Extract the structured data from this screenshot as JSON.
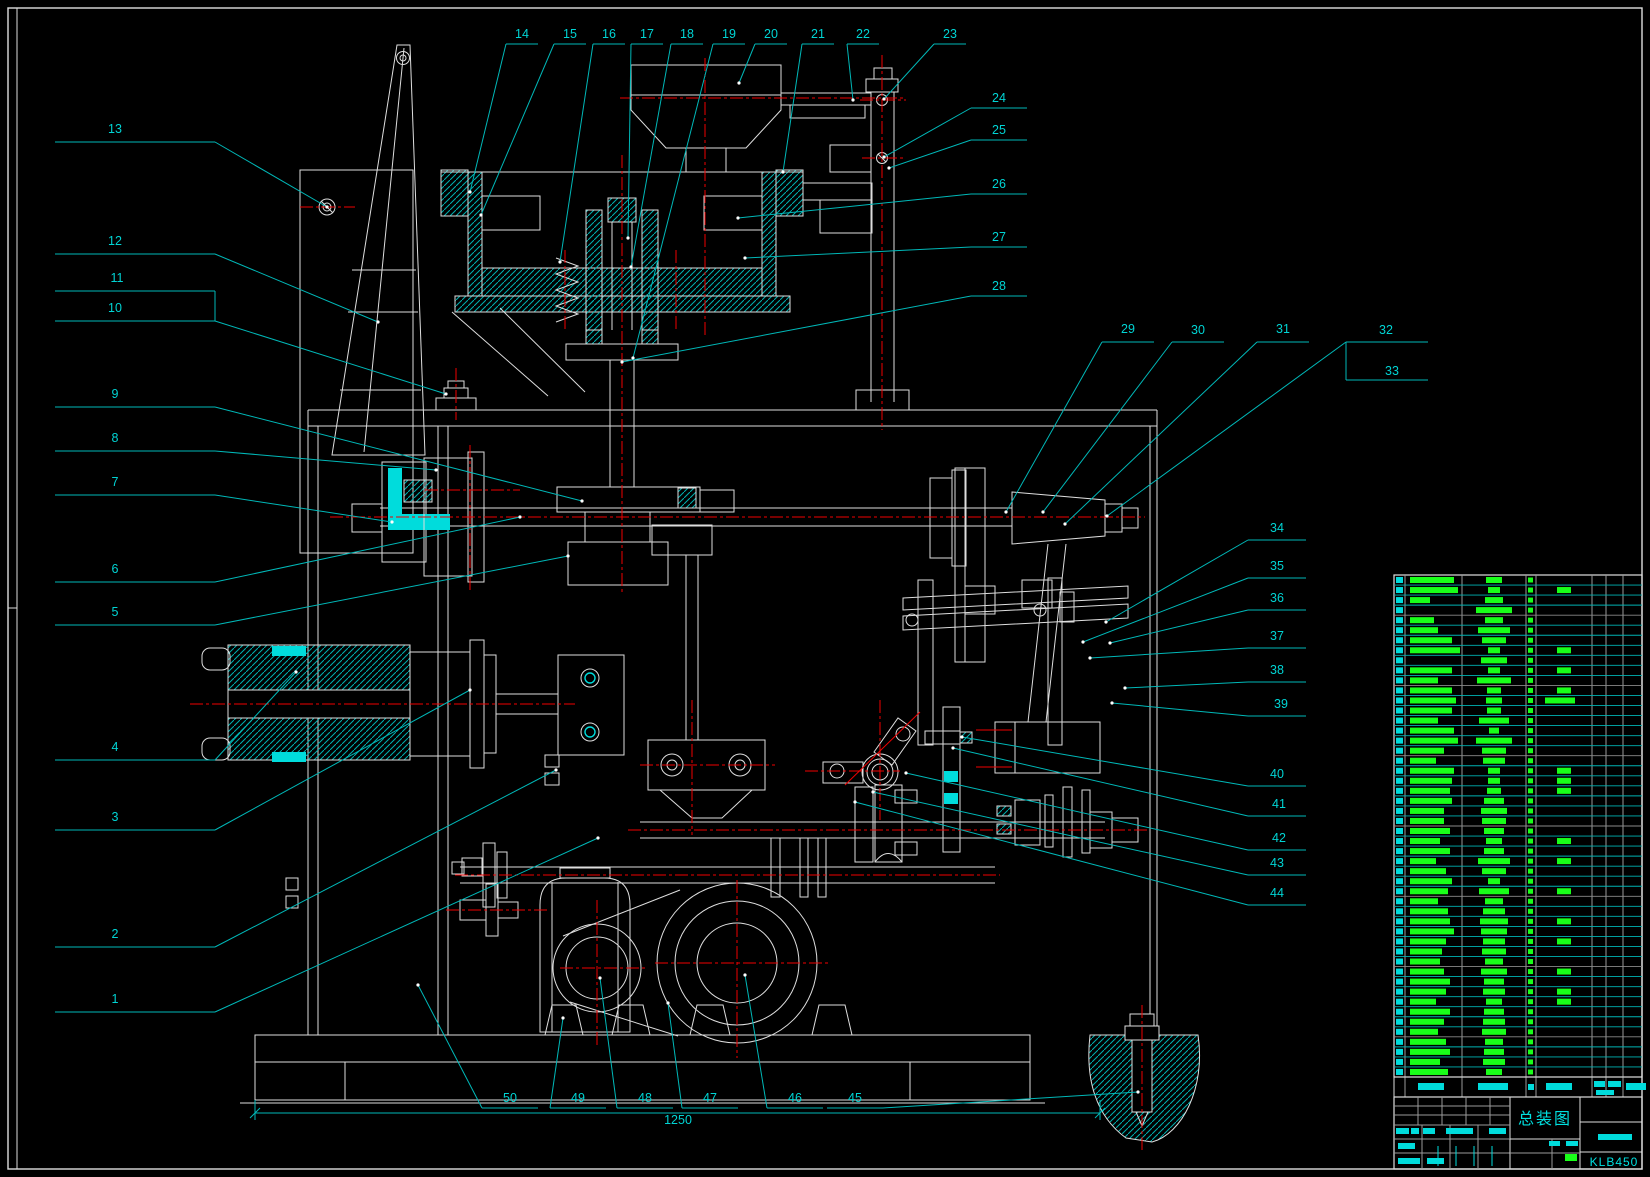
{
  "canvas": {
    "width": 1650,
    "height": 1177,
    "background": "#000000"
  },
  "colors": {
    "geometry_white": "#dedede",
    "leader_cyan": "#00b8b8",
    "text_cyan": "#00d4d4",
    "bright_cyan": "#00dcdc",
    "parts_green": "#19ff19",
    "centerline_red": "#f00000",
    "grid_gray": "#9a9a9a"
  },
  "title_block": {
    "title": "总装图",
    "drawing_number": "KLB450"
  },
  "dimension": {
    "value": "1250"
  },
  "callouts": [
    {
      "n": "1",
      "tx": 115,
      "ty": 1003,
      "line": [
        55,
        1012,
        215
      ],
      "leader": [
        [
          215,
          1012
        ],
        [
          598,
          838
        ]
      ]
    },
    {
      "n": "2",
      "tx": 115,
      "ty": 938,
      "line": [
        55,
        947,
        215
      ],
      "leader": [
        [
          215,
          947
        ],
        [
          556,
          770
        ]
      ]
    },
    {
      "n": "3",
      "tx": 115,
      "ty": 821,
      "line": [
        55,
        830,
        215
      ],
      "leader": [
        [
          215,
          830
        ],
        [
          470,
          690
        ]
      ]
    },
    {
      "n": "4",
      "tx": 115,
      "ty": 751,
      "line": [
        55,
        760,
        215
      ],
      "leader": [
        [
          215,
          760
        ],
        [
          296,
          672
        ]
      ]
    },
    {
      "n": "5",
      "tx": 115,
      "ty": 616,
      "line": [
        55,
        625,
        215
      ],
      "leader": [
        [
          215,
          625
        ],
        [
          568,
          556
        ]
      ]
    },
    {
      "n": "6",
      "tx": 115,
      "ty": 573,
      "line": [
        55,
        582,
        215
      ],
      "leader": [
        [
          215,
          582
        ],
        [
          520,
          517
        ]
      ]
    },
    {
      "n": "7",
      "tx": 115,
      "ty": 486,
      "line": [
        55,
        495,
        215
      ],
      "leader": [
        [
          215,
          495
        ],
        [
          392,
          522
        ]
      ]
    },
    {
      "n": "8",
      "tx": 115,
      "ty": 442,
      "line": [
        55,
        451,
        215
      ],
      "leader": [
        [
          215,
          451
        ],
        [
          436,
          470
        ]
      ]
    },
    {
      "n": "9",
      "tx": 115,
      "ty": 398,
      "line": [
        55,
        407,
        215
      ],
      "leader": [
        [
          215,
          407
        ],
        [
          582,
          501
        ]
      ]
    },
    {
      "n": "10",
      "tx": 115,
      "ty": 312,
      "line": [
        55,
        321,
        215
      ],
      "leader": [
        [
          215,
          321
        ],
        [
          446,
          394
        ]
      ]
    },
    {
      "n": "11",
      "tx": 117,
      "ty": 282,
      "line": [
        55,
        291,
        215
      ],
      "brv": [
        215,
        291,
        215,
        321
      ]
    },
    {
      "n": "12",
      "tx": 115,
      "ty": 245,
      "line": [
        55,
        254,
        215
      ],
      "leader": [
        [
          215,
          254
        ],
        [
          378,
          322
        ]
      ]
    },
    {
      "n": "13",
      "tx": 115,
      "ty": 133,
      "line": [
        55,
        142,
        215
      ],
      "leader": [
        [
          215,
          142
        ],
        [
          327,
          207
        ]
      ]
    },
    {
      "n": "14",
      "tx": 522,
      "ty": 38,
      "line": [
        506,
        44,
        538
      ],
      "leader": [
        [
          506,
          44
        ],
        [
          470,
          192
        ]
      ]
    },
    {
      "n": "15",
      "tx": 570,
      "ty": 38,
      "line": [
        554,
        44,
        586
      ],
      "leader": [
        [
          554,
          44
        ],
        [
          481,
          215
        ]
      ]
    },
    {
      "n": "16",
      "tx": 609,
      "ty": 38,
      "line": [
        593,
        44,
        625
      ],
      "leader": [
        [
          593,
          44
        ],
        [
          560,
          262
        ]
      ]
    },
    {
      "n": "17",
      "tx": 647,
      "ty": 38,
      "line": [
        631,
        44,
        663
      ],
      "leader": [
        [
          631,
          44
        ],
        [
          628,
          238
        ]
      ]
    },
    {
      "n": "18",
      "tx": 687,
      "ty": 38,
      "line": [
        671,
        44,
        703
      ],
      "leader": [
        [
          671,
          44
        ],
        [
          631,
          267
        ]
      ]
    },
    {
      "n": "19",
      "tx": 729,
      "ty": 38,
      "line": [
        713,
        44,
        745
      ],
      "leader": [
        [
          713,
          44
        ],
        [
          633,
          358
        ]
      ]
    },
    {
      "n": "20",
      "tx": 771,
      "ty": 38,
      "line": [
        755,
        44,
        787
      ],
      "leader": [
        [
          755,
          44
        ],
        [
          739,
          83
        ]
      ]
    },
    {
      "n": "21",
      "tx": 818,
      "ty": 38,
      "line": [
        802,
        44,
        834
      ],
      "leader": [
        [
          802,
          44
        ],
        [
          783,
          172
        ]
      ]
    },
    {
      "n": "22",
      "tx": 863,
      "ty": 38,
      "line": [
        847,
        44,
        879
      ],
      "leader": [
        [
          847,
          44
        ],
        [
          853,
          100
        ]
      ]
    },
    {
      "n": "23",
      "tx": 950,
      "ty": 38,
      "line": [
        934,
        44,
        966
      ],
      "leader": [
        [
          934,
          44
        ],
        [
          884,
          99
        ]
      ]
    },
    {
      "n": "24",
      "tx": 999,
      "ty": 102,
      "line": [
        971,
        108,
        1027
      ],
      "leader": [
        [
          971,
          108
        ],
        [
          884,
          157
        ]
      ]
    },
    {
      "n": "25",
      "tx": 999,
      "ty": 134,
      "line": [
        971,
        140,
        1027
      ],
      "leader": [
        [
          971,
          140
        ],
        [
          889,
          168
        ]
      ]
    },
    {
      "n": "26",
      "tx": 999,
      "ty": 188,
      "line": [
        971,
        194,
        1027
      ],
      "leader": [
        [
          971,
          194
        ],
        [
          738,
          218
        ]
      ]
    },
    {
      "n": "27",
      "tx": 999,
      "ty": 241,
      "line": [
        971,
        247,
        1027
      ],
      "leader": [
        [
          971,
          247
        ],
        [
          745,
          258
        ]
      ]
    },
    {
      "n": "28",
      "tx": 999,
      "ty": 290,
      "line": [
        971,
        296,
        1027
      ],
      "leader": [
        [
          971,
          296
        ],
        [
          622,
          362
        ]
      ]
    },
    {
      "n": "29",
      "tx": 1128,
      "ty": 333,
      "line": [
        1102,
        342,
        1154
      ],
      "leader": [
        [
          1102,
          342
        ],
        [
          1006,
          512
        ]
      ]
    },
    {
      "n": "30",
      "tx": 1198,
      "ty": 334,
      "line": [
        1172,
        342,
        1224
      ],
      "leader": [
        [
          1172,
          342
        ],
        [
          1043,
          512
        ]
      ]
    },
    {
      "n": "31",
      "tx": 1283,
      "ty": 333,
      "line": [
        1257,
        342,
        1309
      ],
      "leader": [
        [
          1257,
          342
        ],
        [
          1065,
          524
        ]
      ]
    },
    {
      "n": "32",
      "tx": 1386,
      "ty": 334,
      "line": [
        1346,
        342,
        1428
      ],
      "brv": [
        1346,
        342,
        1346,
        380
      ],
      "leader": [
        [
          1346,
          342
        ],
        [
          1107,
          516
        ]
      ]
    },
    {
      "n": "33",
      "tx": 1392,
      "ty": 375,
      "line": [
        1346,
        380,
        1428
      ]
    },
    {
      "n": "34",
      "tx": 1277,
      "ty": 532,
      "line": [
        1248,
        540,
        1306
      ],
      "leader": [
        [
          1248,
          540
        ],
        [
          1106,
          622
        ]
      ]
    },
    {
      "n": "35",
      "tx": 1277,
      "ty": 570,
      "line": [
        1248,
        578,
        1306
      ],
      "leader": [
        [
          1248,
          578
        ],
        [
          1083,
          642
        ]
      ]
    },
    {
      "n": "36",
      "tx": 1277,
      "ty": 602,
      "line": [
        1248,
        610,
        1306
      ],
      "leader": [
        [
          1248,
          610
        ],
        [
          1110,
          643
        ]
      ]
    },
    {
      "n": "37",
      "tx": 1277,
      "ty": 640,
      "line": [
        1248,
        648,
        1306
      ],
      "leader": [
        [
          1248,
          648
        ],
        [
          1090,
          658
        ]
      ]
    },
    {
      "n": "38",
      "tx": 1277,
      "ty": 674,
      "line": [
        1248,
        682,
        1306
      ],
      "leader": [
        [
          1248,
          682
        ],
        [
          1125,
          688
        ]
      ]
    },
    {
      "n": "39",
      "tx": 1281,
      "ty": 708,
      "line": [
        1248,
        716,
        1306
      ],
      "leader": [
        [
          1248,
          716
        ],
        [
          1112,
          703
        ]
      ]
    },
    {
      "n": "40",
      "tx": 1277,
      "ty": 778,
      "line": [
        1248,
        786,
        1306
      ],
      "leader": [
        [
          1248,
          786
        ],
        [
          962,
          737
        ]
      ]
    },
    {
      "n": "41",
      "tx": 1279,
      "ty": 808,
      "line": [
        1248,
        816,
        1306
      ],
      "leader": [
        [
          1248,
          816
        ],
        [
          953,
          748
        ]
      ]
    },
    {
      "n": "42",
      "tx": 1279,
      "ty": 842,
      "line": [
        1248,
        850,
        1306
      ],
      "leader": [
        [
          1248,
          850
        ],
        [
          906,
          773
        ]
      ]
    },
    {
      "n": "43",
      "tx": 1277,
      "ty": 867,
      "line": [
        1248,
        875,
        1306
      ],
      "leader": [
        [
          1248,
          875
        ],
        [
          873,
          792
        ]
      ]
    },
    {
      "n": "44",
      "tx": 1277,
      "ty": 897,
      "line": [
        1248,
        905,
        1306
      ],
      "leader": [
        [
          1248,
          905
        ],
        [
          855,
          802
        ]
      ]
    },
    {
      "n": "45",
      "tx": 855,
      "ty": 1102,
      "line": [
        827,
        1108,
        883
      ],
      "leader": [
        [
          883,
          1108
        ],
        [
          1138,
          1092
        ]
      ]
    },
    {
      "n": "46",
      "tx": 795,
      "ty": 1102,
      "line": [
        767,
        1108,
        823
      ],
      "leader": [
        [
          767,
          1108
        ],
        [
          745,
          975
        ]
      ]
    },
    {
      "n": "47",
      "tx": 710,
      "ty": 1102,
      "line": [
        682,
        1108,
        738
      ],
      "leader": [
        [
          682,
          1108
        ],
        [
          668,
          1003
        ]
      ]
    },
    {
      "n": "48",
      "tx": 645,
      "ty": 1102,
      "line": [
        617,
        1108,
        673
      ],
      "leader": [
        [
          617,
          1108
        ],
        [
          600,
          978
        ]
      ]
    },
    {
      "n": "49",
      "tx": 578,
      "ty": 1102,
      "line": [
        550,
        1108,
        606
      ],
      "leader": [
        [
          550,
          1108
        ],
        [
          563,
          1018
        ]
      ]
    },
    {
      "n": "50",
      "tx": 510,
      "ty": 1102,
      "line": [
        482,
        1108,
        538
      ],
      "leader": [
        [
          482,
          1108
        ],
        [
          418,
          985
        ]
      ]
    }
  ],
  "parts_table": {
    "left": 1394,
    "top": 575,
    "bottom": 1077,
    "right": 1642,
    "rows": 50,
    "col_edges": [
      1394,
      1405,
      1462,
      1526,
      1536,
      1592,
      1606,
      1623,
      1642
    ],
    "name_bar_widths": [
      44,
      48,
      20,
      0,
      24,
      28,
      42,
      50,
      0,
      42,
      28,
      42,
      46,
      42,
      28,
      44,
      48,
      34,
      26,
      44,
      42,
      40,
      42,
      34,
      34,
      40,
      30,
      40,
      26,
      36,
      42,
      38,
      28,
      38,
      40,
      44,
      36,
      32,
      30,
      34,
      40,
      36,
      26,
      40,
      34,
      28,
      36,
      40,
      30,
      38
    ],
    "spec_bar_widths": [
      16,
      12,
      18,
      36,
      18,
      32,
      24,
      12,
      26,
      12,
      34,
      14,
      16,
      14,
      30,
      10,
      36,
      24,
      22,
      12,
      12,
      14,
      20,
      26,
      24,
      20,
      16,
      20,
      32,
      24,
      12,
      30,
      18,
      22,
      28,
      26,
      22,
      24,
      18,
      26,
      20,
      22,
      16,
      20,
      22,
      24,
      18,
      20,
      22,
      16
    ],
    "material_flags": [
      0,
      1,
      0,
      0,
      0,
      0,
      0,
      1,
      0,
      1,
      0,
      1,
      2,
      0,
      0,
      0,
      0,
      0,
      0,
      1,
      1,
      1,
      0,
      0,
      0,
      0,
      1,
      0,
      1,
      0,
      0,
      1,
      0,
      0,
      1,
      0,
      1,
      0,
      0,
      1,
      0,
      1,
      1,
      0,
      0,
      0,
      0,
      0,
      0,
      0
    ],
    "header": {
      "top": 1077,
      "bottom": 1097,
      "bars": [
        [
          1418,
          1083,
          26,
          7
        ],
        [
          1478,
          1083,
          30,
          7
        ],
        [
          1528,
          1084,
          6,
          6
        ],
        [
          1546,
          1083,
          26,
          7
        ],
        [
          1594,
          1081,
          11,
          6
        ],
        [
          1608,
          1081,
          13,
          6
        ],
        [
          1596,
          1090,
          18,
          5
        ],
        [
          1626,
          1083,
          20,
          7
        ]
      ]
    }
  },
  "title_block_layout": {
    "x1": 1394,
    "y1": 1097,
    "x2": 1642,
    "y2": 1169,
    "rev_grid_right": 1510,
    "title_cell_right": 1580,
    "cyan_bars": [
      [
        1396,
        1128,
        13,
        6
      ],
      [
        1411,
        1128,
        8,
        6
      ],
      [
        1423,
        1128,
        12,
        6
      ],
      [
        1446,
        1128,
        27,
        6
      ],
      [
        1489,
        1128,
        17,
        6
      ],
      [
        1398,
        1143,
        17,
        6
      ],
      [
        1398,
        1158,
        22,
        6
      ],
      [
        1427,
        1158,
        17,
        6
      ],
      [
        1549,
        1141,
        11,
        5
      ],
      [
        1566,
        1141,
        12,
        5
      ],
      [
        1598,
        1134,
        34,
        6
      ]
    ],
    "green_bars": [
      [
        1565,
        1154,
        12,
        7
      ]
    ],
    "date_ticks_x": [
      1438,
      1456,
      1474,
      1492
    ],
    "date_ticks_y": [
      1146,
      1166
    ]
  }
}
